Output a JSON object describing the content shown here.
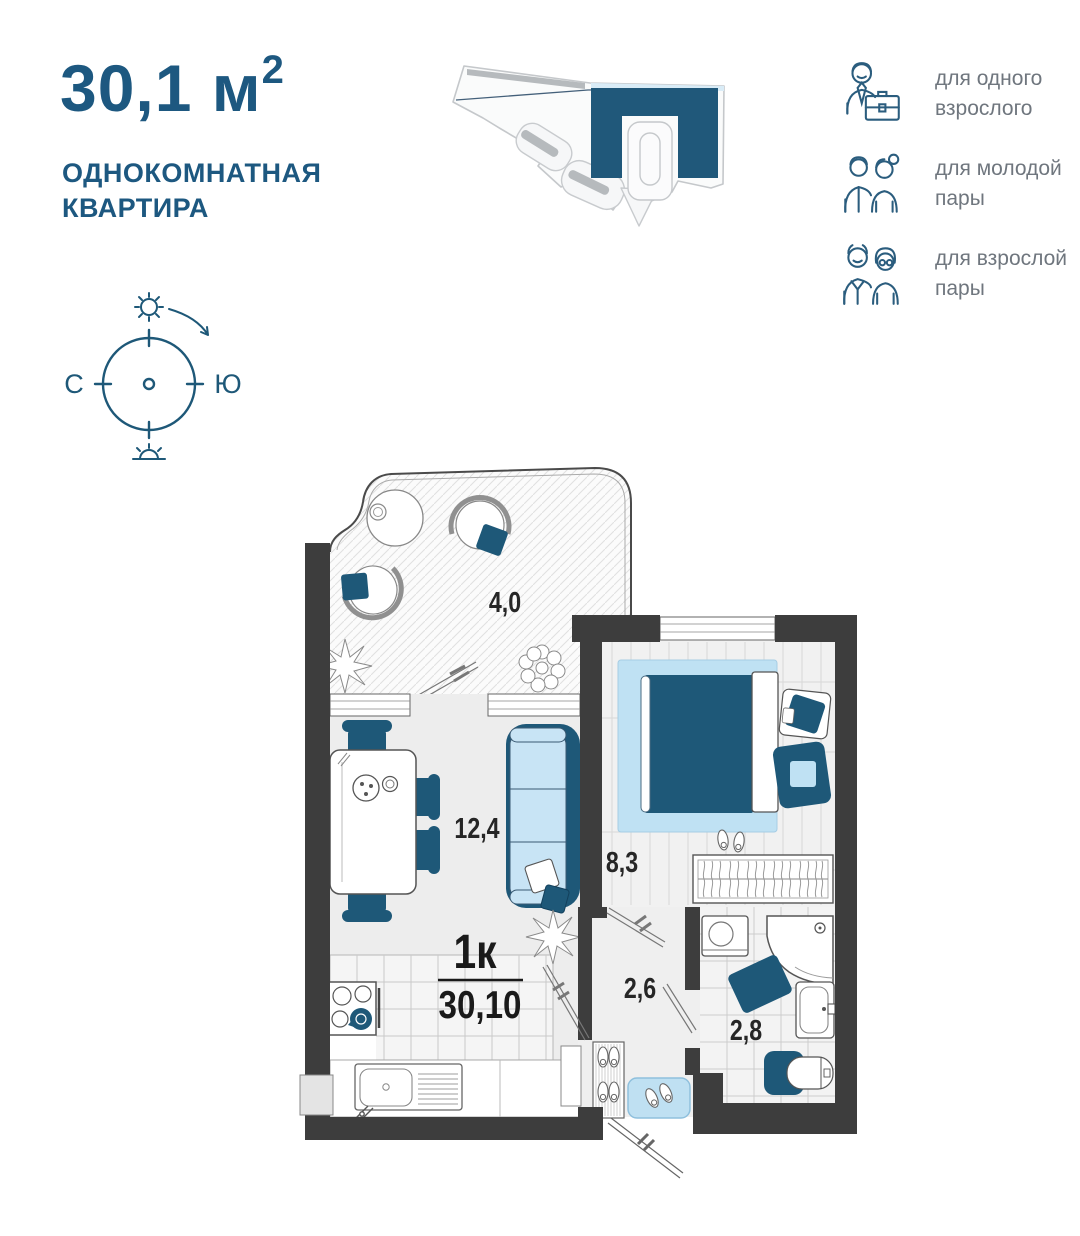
{
  "header": {
    "area_value": "30,1 м",
    "area_exponent": "2",
    "subtitle_line1": "ОДНОКОМНАТНАЯ",
    "subtitle_line2": "КВАРТИРА"
  },
  "audience": {
    "items": [
      {
        "icon": "businessman-icon",
        "label": "для одного взрослого"
      },
      {
        "icon": "young-couple-icon",
        "label": "для молодой пары"
      },
      {
        "icon": "adult-couple-icon",
        "label": "для взрослой пары"
      }
    ]
  },
  "compass": {
    "left_label": "С",
    "right_label": "Ю"
  },
  "plan": {
    "type_label": "1к",
    "total_area": "30,10",
    "balcony_area": "4,0",
    "living_area": "12,4",
    "bedroom_area": "8,3",
    "hall_area": "2,6",
    "bath_area": "2,8"
  },
  "colors": {
    "accent_dark_blue": "#1e5878",
    "accent_light_blue": "#c8e4f5",
    "wall": "#3d3d3d",
    "title_blue": "#1d5880",
    "label_gray": "#6f767e"
  }
}
